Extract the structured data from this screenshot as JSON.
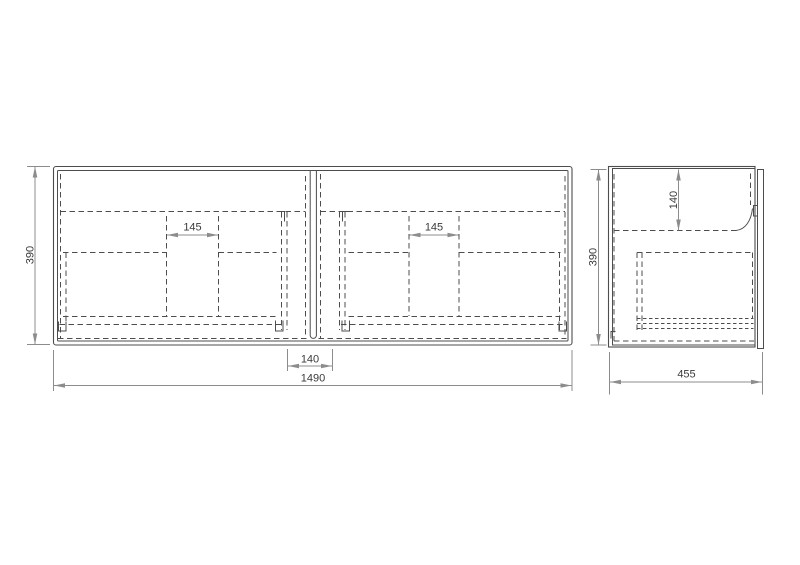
{
  "views": {
    "front": {
      "dims": {
        "height": "390",
        "width": "1490",
        "center_gap": "140",
        "handle_gap_left": "145",
        "handle_gap_right": "145"
      }
    },
    "side": {
      "dims": {
        "height": "390",
        "top_panel_depth": "140",
        "depth": "455"
      }
    }
  },
  "colors": {
    "background": "#ffffff",
    "line": "#4d4d4d",
    "dim": "#8c8c8c",
    "text": "#3a3a3a"
  }
}
